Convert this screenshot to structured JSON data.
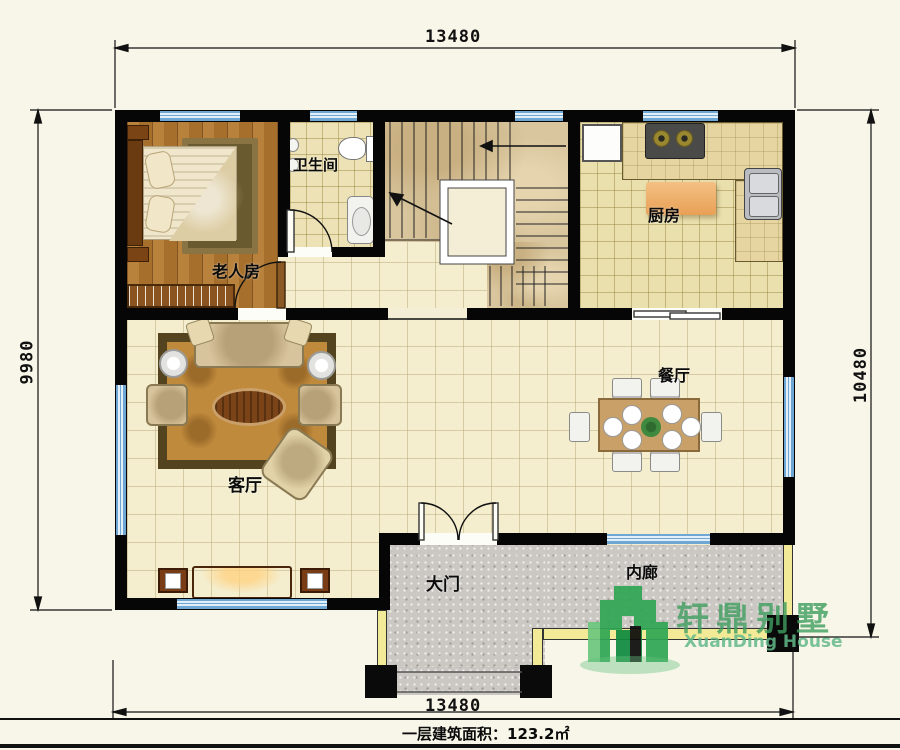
{
  "sheet": {
    "type": "residential floor plan, first floor",
    "area_note": "一层建筑面积：123.2㎡"
  },
  "dimensions": {
    "top": "13480",
    "bottom": "13480",
    "left": "9980",
    "right": "10480"
  },
  "rooms": {
    "bedroom": "老人房",
    "bathroom": "卫生间",
    "kitchen": "厨房",
    "dining": "餐厅",
    "living": "客厅",
    "entrance": "大门",
    "corridor": "内廊"
  },
  "logo": {
    "cn": "轩鼎别墅",
    "en": "XuanDing House"
  },
  "colors": {
    "wall": "#060606",
    "window_blue": "#b9d7ec",
    "floor_cream": "#f4eecf",
    "floor_wood": "#b07a38",
    "floor_kitchen": "#eae0ae",
    "floor_marble": "#d9c69e",
    "porch_gray": "#cbc8c3",
    "curb_yellow": "#f2ea96",
    "logo_green": "#2fa654"
  }
}
